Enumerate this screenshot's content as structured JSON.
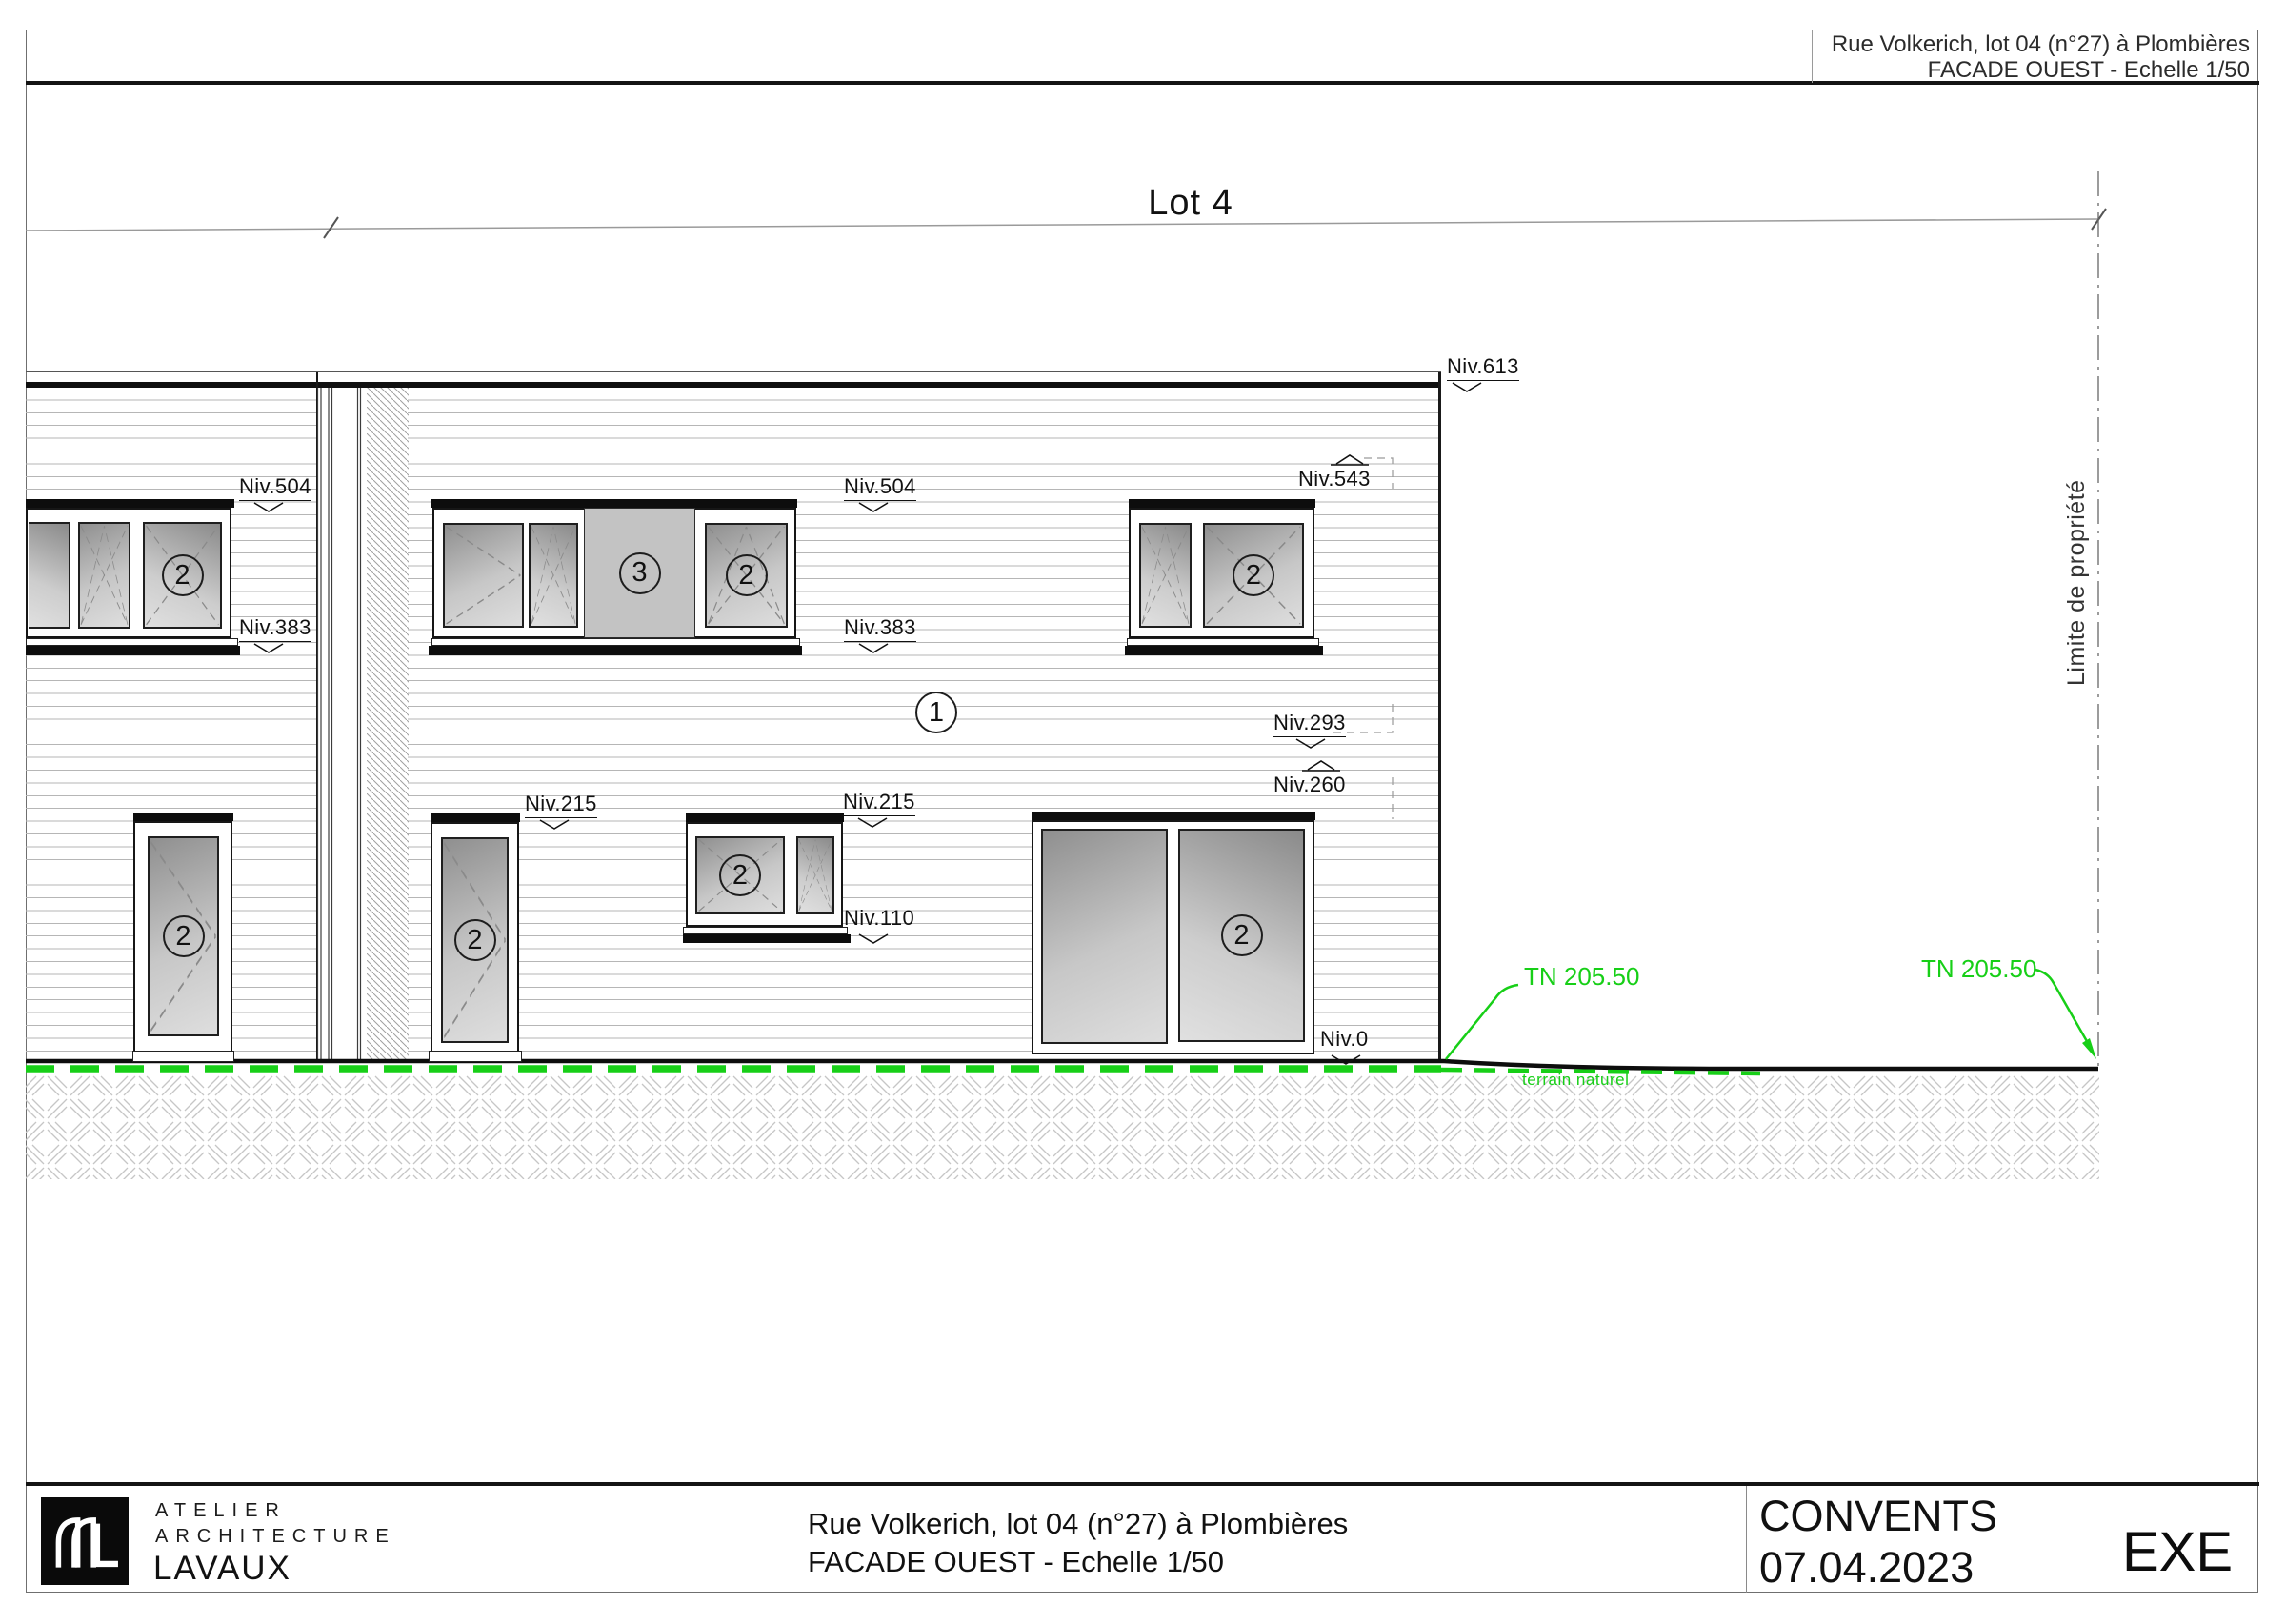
{
  "header": {
    "address": "Rue Volkerich, lot 04 (n°27) à Plombières",
    "drawing_title": "FACADE OUEST - Echelle 1/50"
  },
  "drawing": {
    "lot_label": "Lot 4",
    "property_limit_label": "Limite de propriété",
    "levels": {
      "niv613": "Niv.613",
      "niv543": "Niv.543",
      "niv504": "Niv.504",
      "niv383": "Niv.383",
      "niv293": "Niv.293",
      "niv260": "Niv.260",
      "niv215": "Niv.215",
      "niv110": "Niv.110",
      "niv0": "Niv.0"
    },
    "tags": {
      "facade": "1",
      "window": "2",
      "panel": "3"
    },
    "terrain": {
      "tn": "TN 205.50",
      "natural_ground_label": "terrain naturel",
      "color": "#17cf17"
    }
  },
  "titleblock": {
    "firm": {
      "line1": "ATELIER",
      "line2": "ARCHITECTURE",
      "line3": "LAVAUX"
    },
    "project_address": "Rue Volkerich, lot 04 (n°27) à Plombières",
    "drawing_title": "FACADE OUEST - Echelle 1/50",
    "project_name": "CONVENTS",
    "date": "07.04.2023",
    "status": "EXE"
  }
}
